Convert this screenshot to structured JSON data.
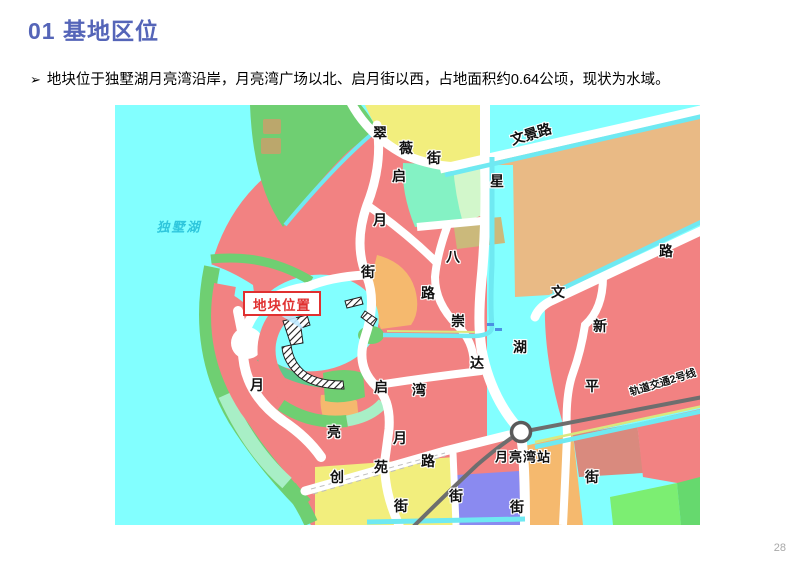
{
  "slide": {
    "title": "01 基地区位",
    "bullet_marker": "➢",
    "bullet": "地块位于独墅湖月亮湾沿岸，月亮湾广场以北、启月街以西，占地面积约0.64公顷，现状为水域。",
    "page": "28"
  },
  "map": {
    "callout": {
      "text": "地块位置"
    },
    "labels": [
      {
        "t": "翠",
        "x": 265,
        "y": 28
      },
      {
        "t": "薇",
        "x": 291,
        "y": 43
      },
      {
        "t": "街",
        "x": 319,
        "y": 53
      },
      {
        "t": "启",
        "x": 284,
        "y": 71
      },
      {
        "t": "月",
        "x": 265,
        "y": 115
      },
      {
        "t": "街",
        "x": 253,
        "y": 167
      },
      {
        "t": "星",
        "x": 382,
        "y": 76
      },
      {
        "t": "湖",
        "x": 405,
        "y": 242
      },
      {
        "t": "街",
        "x": 402,
        "y": 402
      },
      {
        "t": "文景路",
        "x": 416,
        "y": 29,
        "r": -17
      },
      {
        "t": "路",
        "x": 551,
        "y": 146
      },
      {
        "t": "文",
        "x": 443,
        "y": 187
      },
      {
        "t": "八",
        "x": 338,
        "y": 152
      },
      {
        "t": "路",
        "x": 313,
        "y": 188
      },
      {
        "t": "崇",
        "x": 343,
        "y": 216
      },
      {
        "t": "达",
        "x": 362,
        "y": 258
      },
      {
        "t": "湾",
        "x": 304,
        "y": 285
      },
      {
        "t": "启",
        "x": 266,
        "y": 282
      },
      {
        "t": "月",
        "x": 142,
        "y": 280
      },
      {
        "t": "新",
        "x": 485,
        "y": 221
      },
      {
        "t": "平",
        "x": 477,
        "y": 281
      },
      {
        "t": "街",
        "x": 477,
        "y": 372
      },
      {
        "t": "亮",
        "x": 219,
        "y": 327
      },
      {
        "t": "月",
        "x": 285,
        "y": 333
      },
      {
        "t": "创",
        "x": 222,
        "y": 372
      },
      {
        "t": "苑",
        "x": 266,
        "y": 362
      },
      {
        "t": "路",
        "x": 313,
        "y": 356
      },
      {
        "t": "街",
        "x": 286,
        "y": 401
      },
      {
        "t": "街",
        "x": 341,
        "y": 391
      },
      {
        "t": "月亮湾站",
        "x": 408,
        "y": 352,
        "c": "station"
      },
      {
        "t": "轨道交通2号线",
        "x": 548,
        "y": 278,
        "r": -17,
        "c": "rail"
      },
      {
        "t": "独墅湖",
        "x": 64,
        "y": 122,
        "c": "lake"
      }
    ],
    "colors": {
      "lake": "#82FFFF",
      "green": "#6FCF72",
      "teal": "#A8EFC6",
      "mint": "#84F2C4",
      "pale_green": "#D2F7CB",
      "yellow": "#F2EE7D",
      "tan": "#E9BA85",
      "red": "#F28282",
      "orange": "#F5B96E",
      "khaki": "#CBB97B",
      "dull_red": "#D98A7E",
      "periwinkle": "#8A8AF0",
      "bright_green": "#7CEE72",
      "mid_green": "#66D96E",
      "road": "#FFFFFF",
      "canal": "#6FE9F2",
      "road_edge": "#D9E87E",
      "rail": "#6E6E6E",
      "watermark": "#C9A06B",
      "bay_edge_green": "#5FC98A",
      "callout_red": "#E03030",
      "bridge_blue": "#4A90E2"
    }
  }
}
